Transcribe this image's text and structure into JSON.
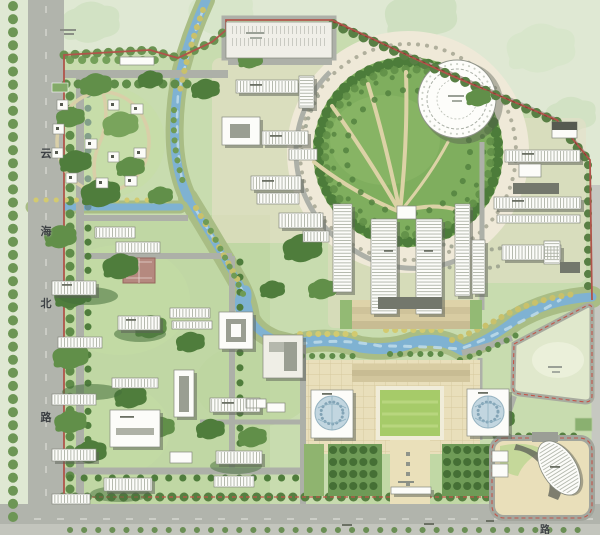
{
  "roads": {
    "west_vertical": {
      "name": "云海北路",
      "chars": [
        "云",
        "海",
        "北",
        "路"
      ]
    },
    "south_horizontal": {
      "visible_label": "路"
    }
  },
  "colors": {
    "water": "#7fb2d2",
    "water_light": "#bcd9e8",
    "road": "#b1b4ac",
    "site_green": "#c8dcaf",
    "canopy_dark": "#4f7d3c",
    "canopy_mid": "#618f49",
    "paving": "#e9dfbb",
    "lawn": "#a6cb69",
    "building": "#fcfcf9",
    "building_shadow": "#5c6157",
    "boundary_red": "#b0544a",
    "court_pink": "#b5897f",
    "dome_blue": "#c2d6e0",
    "context_wash": "#dfe8d3"
  }
}
